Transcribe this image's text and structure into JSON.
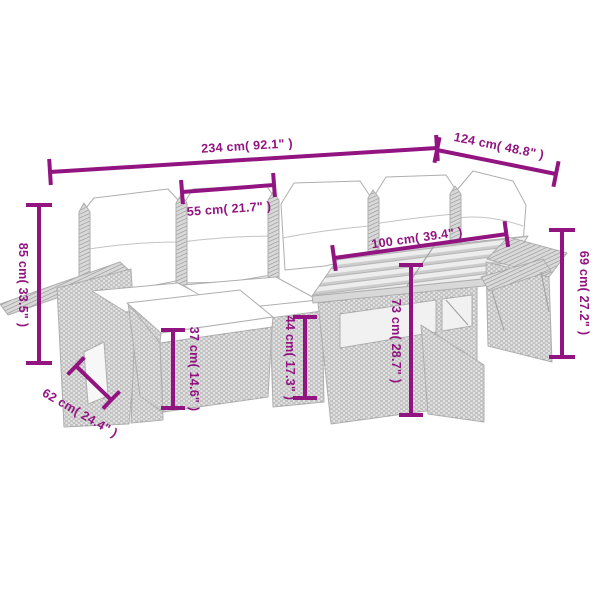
{
  "image": {
    "description": "Line drawing of a 7-piece poly rattan garden corner sofa set (sofa sections with white cushions, footstool, slatted wood-top table, armrest trays) annotated with magenta dimension lines",
    "background": "#ffffff"
  },
  "palette": {
    "dimension": "#911480",
    "outline": "#aeaeae",
    "cushion": "#ffffff",
    "weave_light": "#e3e3e3",
    "weave_dark": "#a2a2a2",
    "wood_light": "#ededed",
    "wood_dark": "#cccccc"
  },
  "dimensions": {
    "overall_width": {
      "label": "234 cm( 92.1\" )",
      "cm": 234,
      "inches": 92.1
    },
    "overall_depth": {
      "label": "124 cm( 48.8\" )",
      "cm": 124,
      "inches": 48.8
    },
    "seat_width": {
      "label": "55 cm( 21.7\" )",
      "cm": 55,
      "inches": 21.7
    },
    "table_width": {
      "label": "100 cm( 39.4\" )",
      "cm": 100,
      "inches": 39.4
    },
    "total_height": {
      "label": "85 cm( 33.5\" )",
      "cm": 85,
      "inches": 33.5
    },
    "right_height": {
      "label": "69 cm( 27.2\" )",
      "cm": 69,
      "inches": 27.2
    },
    "footstool_height": {
      "label": "37 cm( 14.6\" )",
      "cm": 37,
      "inches": 14.6
    },
    "seat_height": {
      "label": "44 cm( 17.3\" )",
      "cm": 44,
      "inches": 17.3
    },
    "table_height": {
      "label": "73 cm( 28.7\" )",
      "cm": 73,
      "inches": 28.7
    },
    "seat_depth": {
      "label": "62 cm( 24.4\" )",
      "cm": 62,
      "inches": 24.4
    }
  }
}
